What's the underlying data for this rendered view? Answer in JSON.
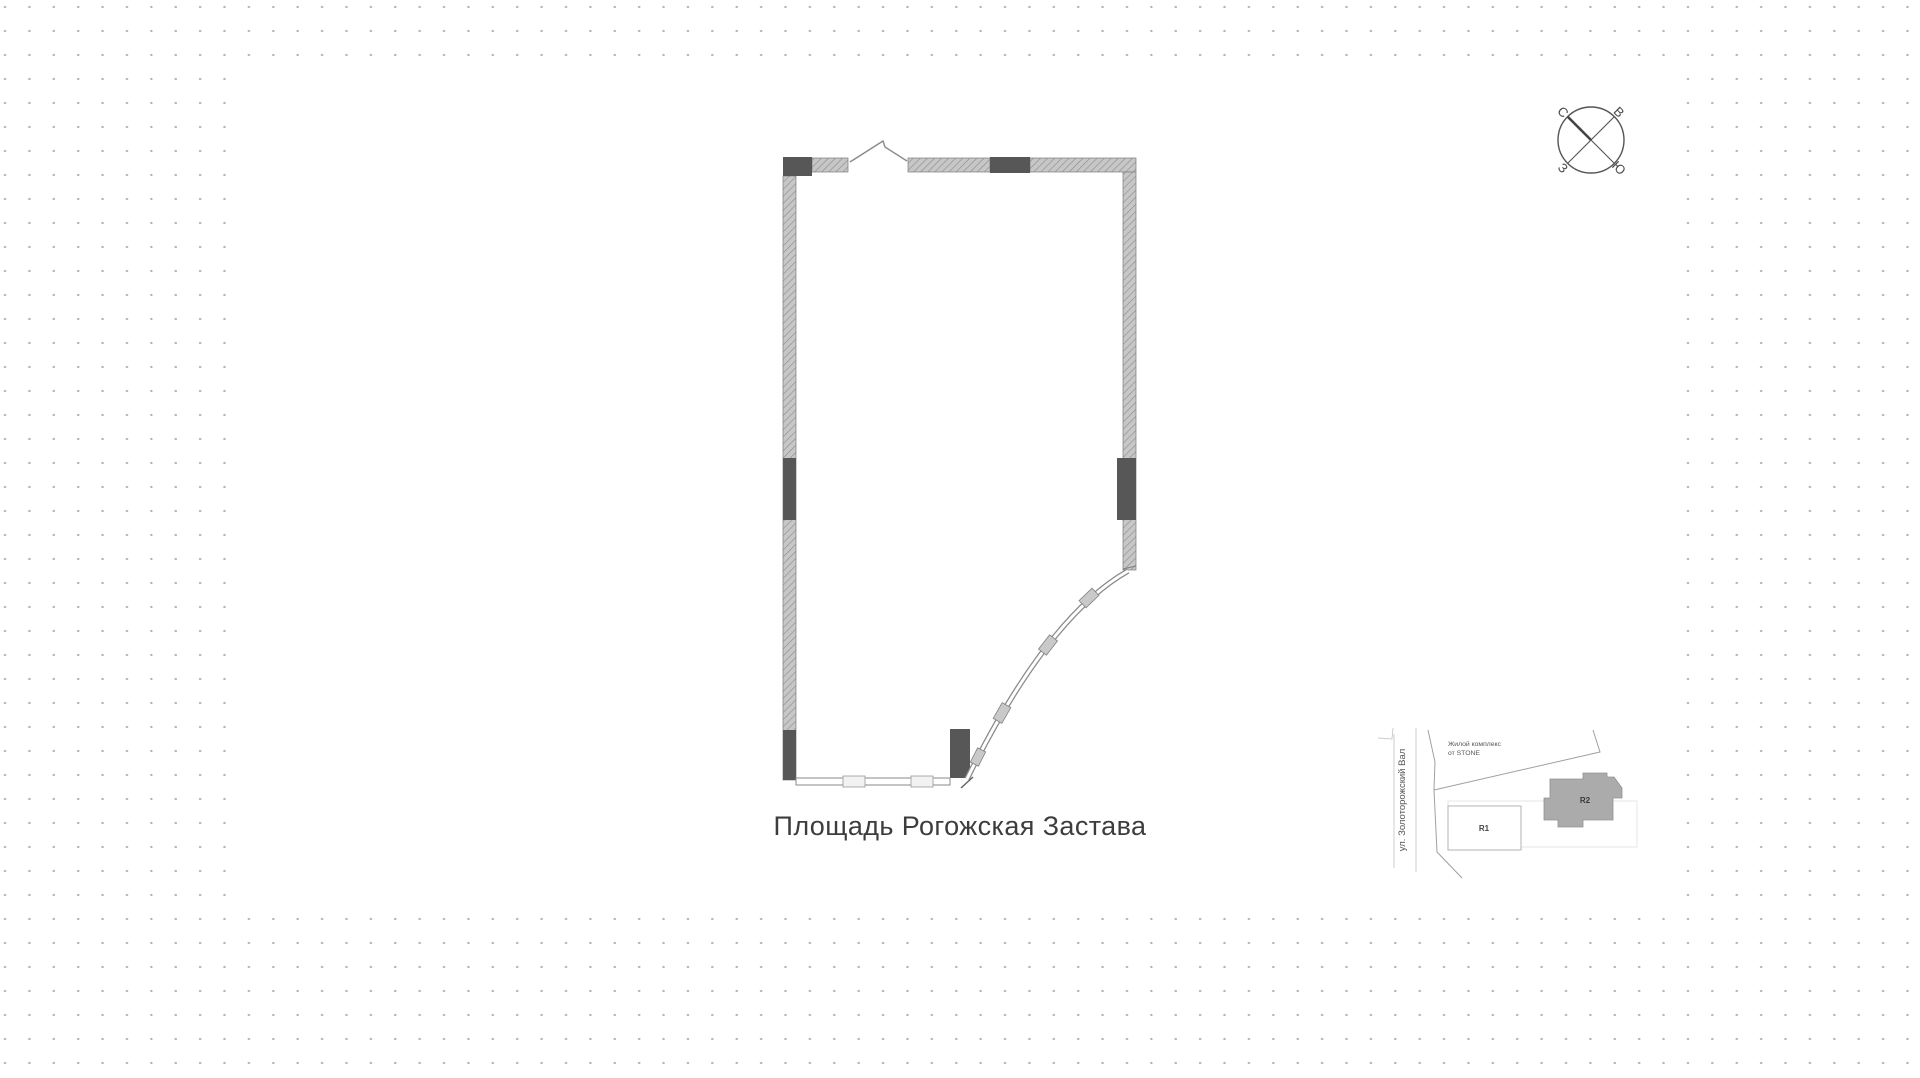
{
  "page": {
    "title_label": "Площадь Рогожская Застава"
  },
  "compass": {
    "north": "С",
    "east": "В",
    "west": "З",
    "south": "Ю"
  },
  "minimap": {
    "street_label": "ул. Золоторожский Вал",
    "complex_line1": "Жилой комплекс",
    "complex_line2": "от STONE",
    "r1_label": "R1",
    "r2_label": "R2"
  },
  "colors": {
    "dot": "#b7b7b7",
    "wall_fill": "#c7c7c7",
    "wall_hatch": "#8f8f8f",
    "wall_outline": "#7d7d7d",
    "column_fill": "#575757",
    "glazing_line": "#8a8a8a",
    "title_text": "#3d3d3d",
    "compass_line": "#555555",
    "map_line": "#a0a0a0",
    "map_building_fill": "#ababab",
    "map_text": "#555555"
  }
}
